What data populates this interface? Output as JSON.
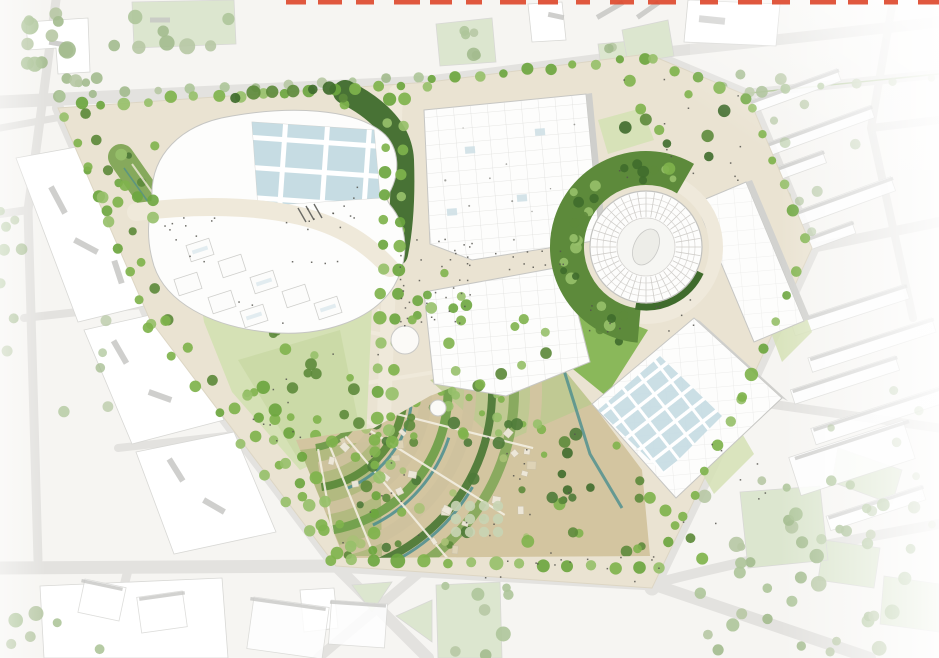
{
  "image": {
    "kind": "architectural-masterplan-site-plan",
    "description": "Aerial masterplan rendering of a large triangular urban development site containing exhibition halls, a circular arena, a central park, fan-shaped terraced gardens with water channels, and tree-lined boulevards, surrounded by faded white city context blocks",
    "width": 939,
    "height": 658
  },
  "cropped_title": {
    "note": "bottoms of large red heading letters cropped at the very top edge of the image",
    "color": "#dd4a2f"
  },
  "palette": {
    "canvas": "#f6f5f2",
    "context_road": "#e3e2df",
    "context_block": "#ffffff",
    "context_block_line": "#d8d8d5",
    "context_block_shadow": "#c7c7c4",
    "context_lawn": "#dce6cf",
    "context_tree": "#aec59a",
    "site_ground": "#eae3d2",
    "site_path": "#efe9da",
    "building_white": "#fdfdfc",
    "building_outline": "#c6c6c3",
    "building_grid": "#dadad7",
    "glass_blue": "#c3dae1",
    "tree_bright": "#7fb34c",
    "tree_mid": "#5d8a3b",
    "tree_dark": "#3f6b2c",
    "lawn_light": "#d5e1b5",
    "lawn_pale": "#e3eacb",
    "garden_tan": "#d3c5a0",
    "garden_tan2": "#cfc29e",
    "water_teal": "#4a8d8f",
    "people": "#55544e",
    "red_accent": "#dd4a2f"
  },
  "features": [
    {
      "id": "cropped-red-title",
      "kind": "text-fragments"
    },
    {
      "id": "west-mixed-use-cluster",
      "kind": "building"
    },
    {
      "id": "north-exhibition-hall",
      "kind": "building"
    },
    {
      "id": "central-hall",
      "kind": "building"
    },
    {
      "id": "southeast-hall",
      "kind": "building"
    },
    {
      "id": "east-slab-building",
      "kind": "building"
    },
    {
      "id": "circular-arena",
      "kind": "building"
    },
    {
      "id": "central-park",
      "kind": "green-space"
    },
    {
      "id": "linear-park-strip",
      "kind": "green-space"
    },
    {
      "id": "terraced-gardens",
      "kind": "green-space"
    },
    {
      "id": "arena-green-band",
      "kind": "green-space"
    },
    {
      "id": "boulevard-tree-rows",
      "kind": "vegetation"
    },
    {
      "id": "water-channels",
      "kind": "water"
    },
    {
      "id": "context-city-blocks",
      "kind": "context"
    },
    {
      "id": "context-streets",
      "kind": "context"
    }
  ]
}
